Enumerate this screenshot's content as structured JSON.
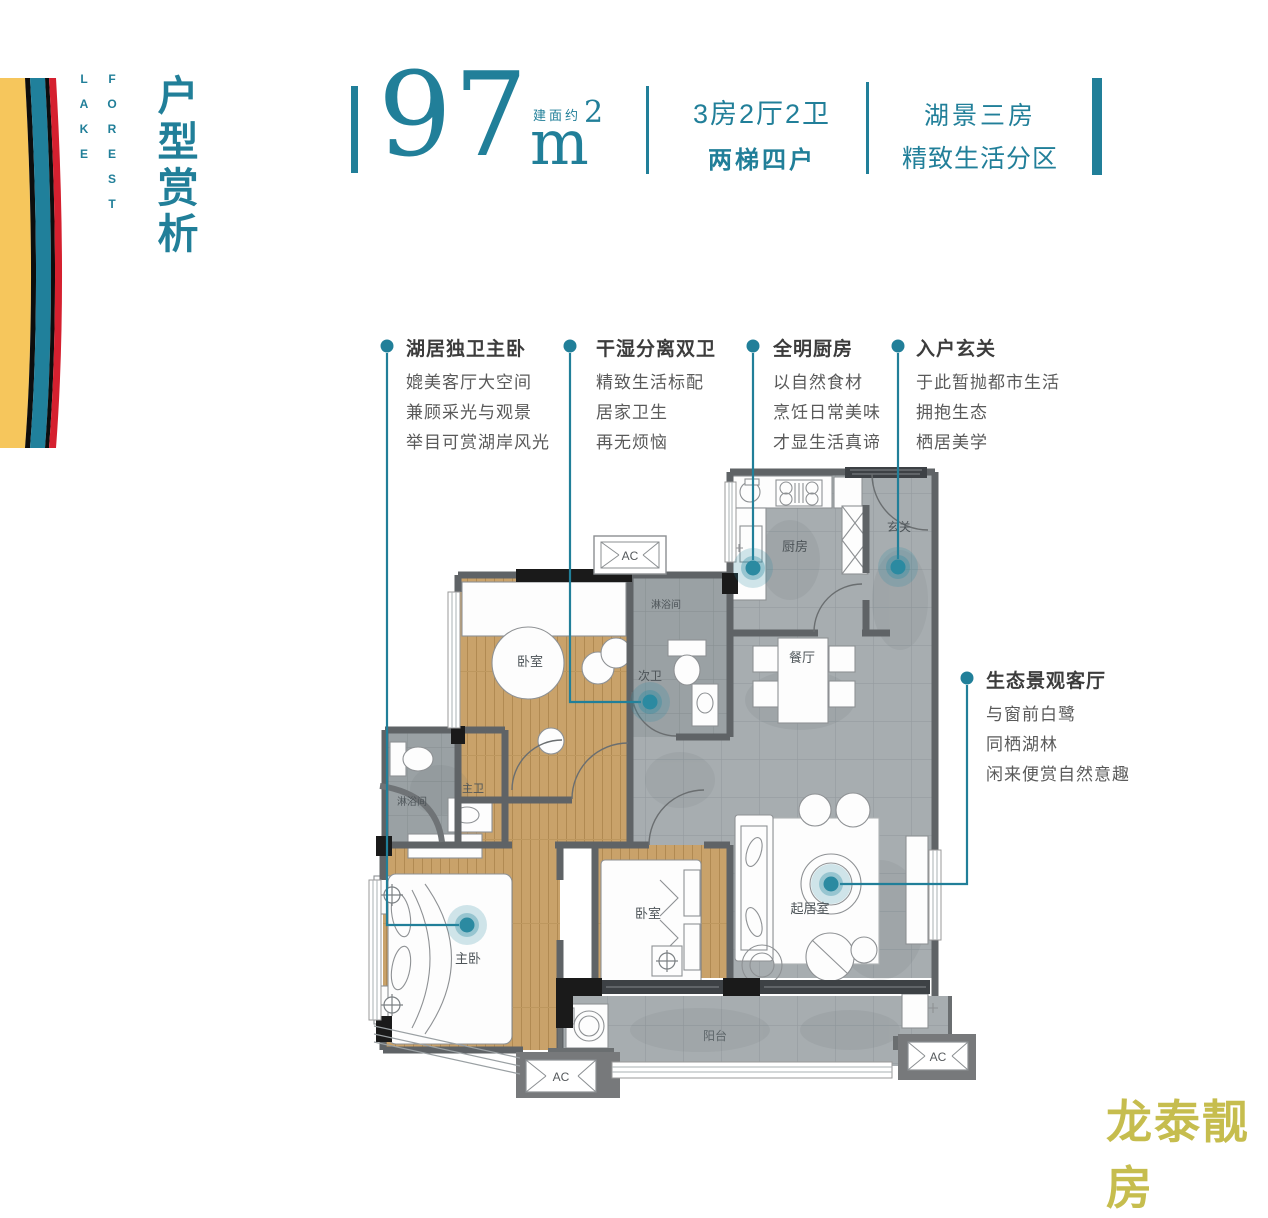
{
  "accent_color": "#217f99",
  "watermark_color": "#c6bd4e",
  "brand": {
    "line1": "FOREST",
    "line2": "LAKE"
  },
  "page_title": "户型赏析",
  "header": {
    "area_label": "建面约",
    "area_value": "97",
    "area_unit": "m",
    "area_exponent": "2",
    "spec_line1": "3房2厅2卫",
    "spec_line2": "两梯四户",
    "tagline_line1": "湖景三房",
    "tagline_line2": "精致生活分区"
  },
  "annotations": [
    {
      "title": "湖居独卫主卧",
      "lines": [
        "媲美客厅大空间",
        "兼顾采光与观景",
        "举目可赏湖岸风光"
      ]
    },
    {
      "title": "干湿分离双卫",
      "lines": [
        "精致生活标配",
        "居家卫生",
        "再无烦恼"
      ]
    },
    {
      "title": "全明厨房",
      "lines": [
        "以自然食材",
        "烹饪日常美味",
        "才显生活真谛"
      ]
    },
    {
      "title": "入户玄关",
      "lines": [
        "于此暂抛都市生活",
        "拥抱生态",
        "栖居美学"
      ]
    },
    {
      "title": "生态景观客厅",
      "lines": [
        "与窗前白鹭",
        "同栖湖林",
        "闲来便赏自然意趣"
      ]
    }
  ],
  "floorplan": {
    "labels": {
      "bedroom": "卧室",
      "master_bedroom": "主卧",
      "second_bath": "次卫",
      "master_bath": "主卫",
      "shower": "淋浴间",
      "kitchen": "厨房",
      "foyer": "玄关",
      "dining": "餐厅",
      "living": "起居室",
      "balcony": "阳台",
      "ac": "AC"
    }
  },
  "watermark": "龙泰靓房"
}
